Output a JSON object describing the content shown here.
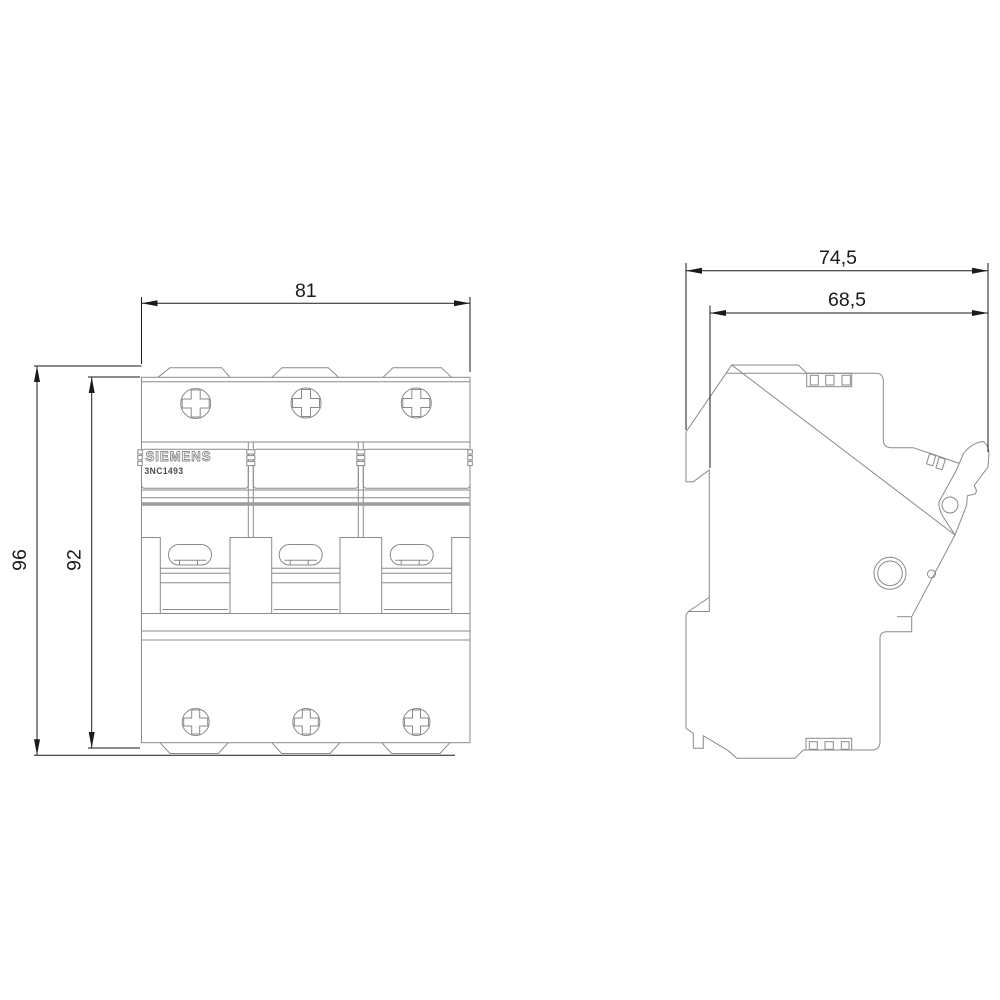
{
  "product": {
    "brand": "SIEMENS",
    "model": "3NC1493"
  },
  "front_view": {
    "dim_width": "81",
    "dim_height_overall": "96",
    "dim_height_body": "92"
  },
  "side_view": {
    "dim_depth_overall": "74,5",
    "dim_depth_body": "68,5"
  },
  "colors": {
    "outline": "#8a8a8a",
    "dimension": "#1a1a1a",
    "thick_band": "#9e9e9e",
    "background": "#ffffff"
  }
}
